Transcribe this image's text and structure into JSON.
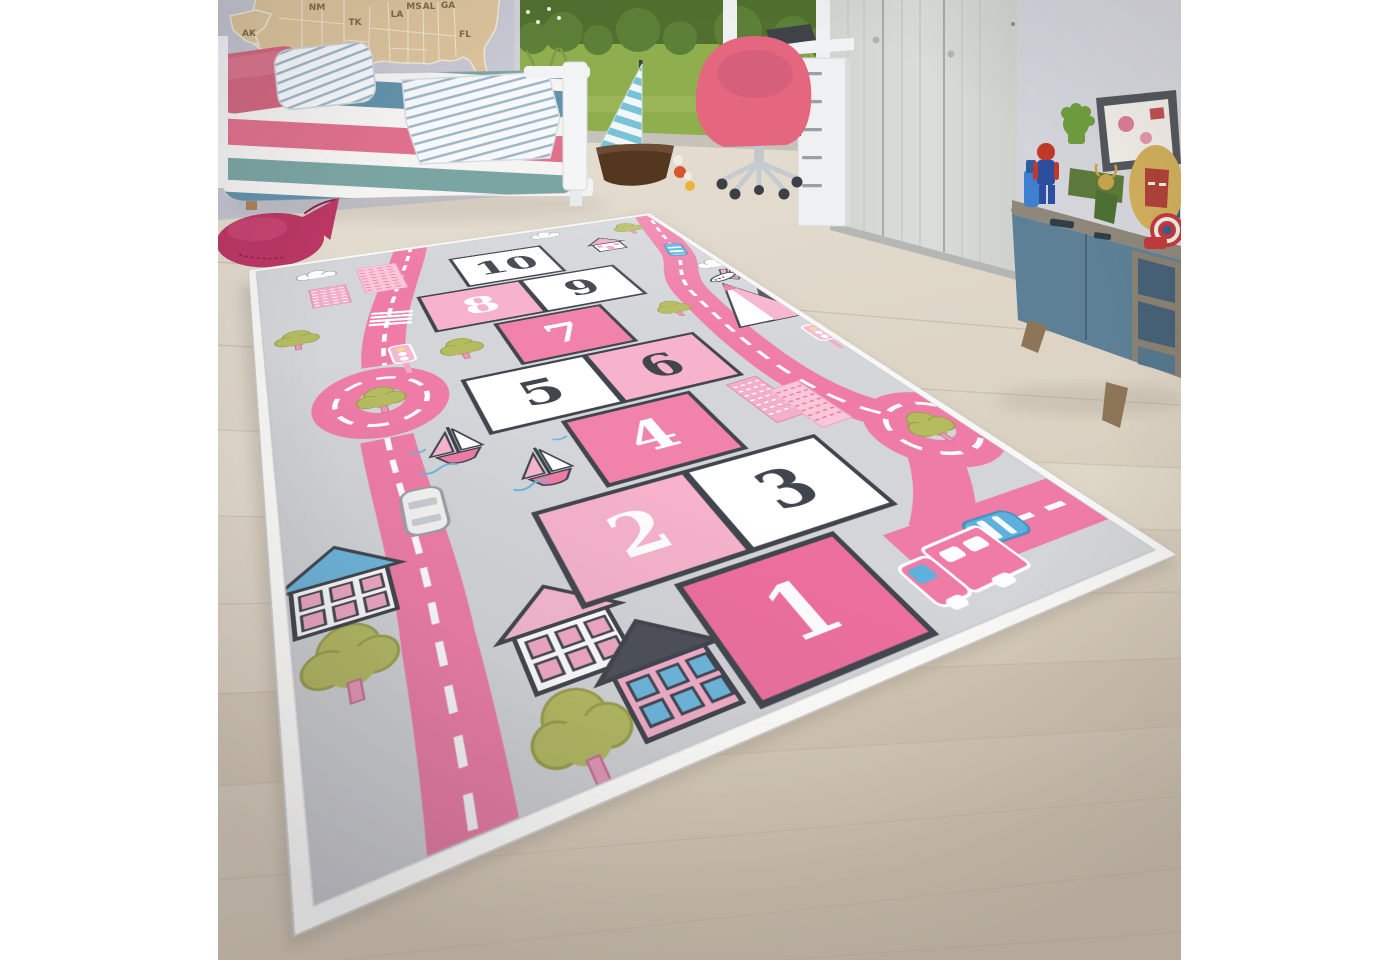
{
  "photo": {
    "subject": "children's room with a pink-grey hopscotch street play rug on a light wood floor"
  },
  "wall_map": {
    "state_labels": [
      "AK",
      "NM",
      "TK",
      "LA",
      "MS",
      "AL",
      "GA",
      "FL"
    ]
  },
  "rug": {
    "numbers": [
      "10",
      "9",
      "8",
      "7",
      "6",
      "5",
      "4",
      "3",
      "2",
      "1"
    ],
    "colors": {
      "field": "#d3d5d8",
      "binding": "#f7f7f5",
      "road": "#ef7ca6",
      "box_bright_pink": "#ee6f9d",
      "box_mid_pink": "#f183aa",
      "box_light_pink": "#f6b3cb",
      "box_white": "#ffffff",
      "number_dark": "#41454e",
      "tree_green": "#b5bc60",
      "car_blue": "#5fb0dc",
      "roof_blue": "#6cb7de",
      "roof_dark": "#4a4e57"
    }
  },
  "room_palette": {
    "wall": "#c9cbd6",
    "floor": "#ddd5c7",
    "map_wood": "#dcc49c",
    "lawn": "#8fae4d",
    "chair_pink": "#e4677f",
    "wardrobe": "#d7d9d5",
    "sideboard_teal": "#5d8096",
    "plush_whale": "#bb3764",
    "bed_stripe_pink": "#e0718d",
    "bed_stripe_teal": "#7ba5a3",
    "bed_stripe_blue": "#6292ab"
  }
}
